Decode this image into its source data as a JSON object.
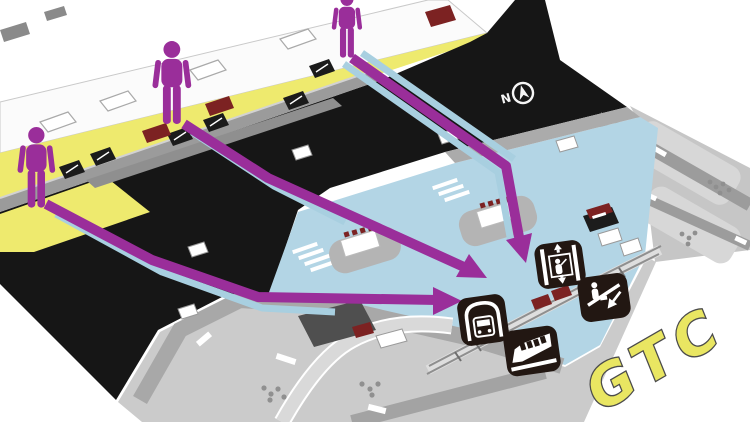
{
  "title": "Airport Ground Transportation Center (GTC) wayfinding map",
  "labels": {
    "gtc": "GTC",
    "compass_north": "N"
  },
  "colors": {
    "route_purple": "#9a2e9a",
    "walkway_blue": "#a8cfe0",
    "curbside_yellow": "#eeea6e",
    "roadway_black": "#161616",
    "plaza_blue": "#b3d5e5",
    "icon_square": "#221712",
    "accent_red": "#7c2222",
    "gtc_letters": "#e9e662"
  },
  "icons": [
    {
      "name": "person-icon",
      "meaning": "traveler standing at terminal curbside",
      "count": 3
    },
    {
      "name": "elevator-icon",
      "meaning": "elevator to lower level"
    },
    {
      "name": "escalator-down-icon",
      "meaning": "escalator going down"
    },
    {
      "name": "subway-icon",
      "meaning": "subway / underground rail station"
    },
    {
      "name": "monorail-icon",
      "meaning": "monorail / automated people mover"
    },
    {
      "name": "compass-north-icon",
      "meaning": "north direction indicator"
    }
  ],
  "routes": [
    {
      "id": "route-left",
      "from": "left curbside traveler",
      "to": "subway and monorail station entrance"
    },
    {
      "id": "route-center",
      "from": "center curbside traveler",
      "to": "station plaza entrance"
    },
    {
      "id": "route-top",
      "from": "upper curbside traveler",
      "to": "elevator and escalator down to GTC"
    }
  ]
}
